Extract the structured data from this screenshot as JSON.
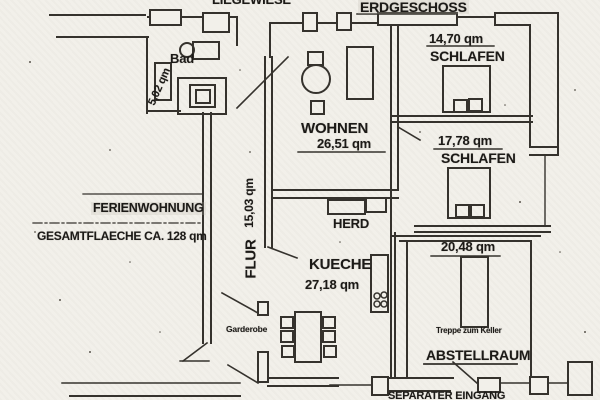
{
  "plan": {
    "header": {
      "liegewiese": "LIEGEWIESE",
      "erdgeschoss": "ERDGESCHOSS"
    },
    "rooms": {
      "bad": {
        "name": "Bad",
        "area": "5,02 qm"
      },
      "wohnen": {
        "name": "WOHNEN",
        "area": "26,51 qm"
      },
      "schlafen1": {
        "name": "SCHLAFEN",
        "area": "14,70 qm"
      },
      "schlafen2": {
        "name": "SCHLAFEN",
        "area": "17,78 qm"
      },
      "flur": {
        "name": "FLUR",
        "area": "15,03 qm"
      },
      "kueche": {
        "name": "KUECHE",
        "area": "27,18 qm"
      },
      "abstellraum": {
        "name": "ABSTELLRAUM",
        "area": "20,48 qm"
      }
    },
    "labels": {
      "herd": "HERD",
      "garderobe": "Garderobe",
      "treppe_zum_keller": "Treppe zum Keller",
      "eingang": "SEPARATER EINGANG",
      "ferienwohnung": "FERIENWOHNUNG",
      "gesamtflaeche": "GESAMTFLAECHE CA. 128 qm"
    },
    "colors": {
      "paper": "#f2f0ea",
      "line": "#35322d",
      "text": "#1c1a17"
    }
  }
}
